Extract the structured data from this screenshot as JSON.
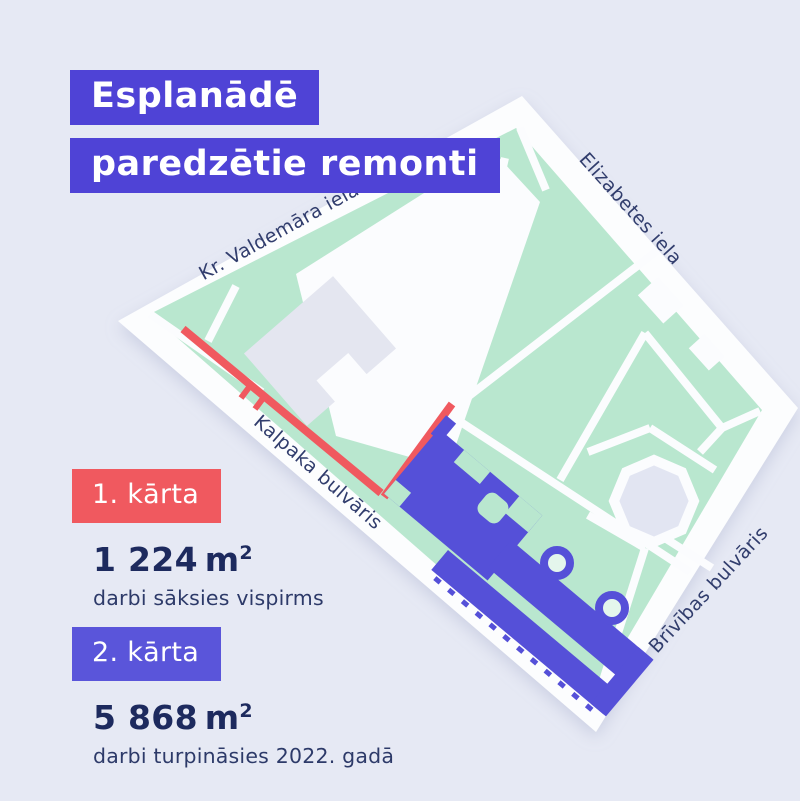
{
  "page": {
    "background_color": "#e6e9f4"
  },
  "title": {
    "line1": "Esplanādē",
    "line2": "paredzētie remonti",
    "bg_color": "#4f43d6",
    "text_color": "#ffffff"
  },
  "map": {
    "streets": [
      {
        "id": "kr-valdemara-iela",
        "label": "Kr. Valdemāra iela"
      },
      {
        "id": "elizabetes-iela",
        "label": "Elizabetes iela"
      },
      {
        "id": "kalpaka-bulvaris",
        "label": "Kalpaka bulvāris"
      },
      {
        "id": "brivibas-bulvaris",
        "label": "Brīvības bulvāris"
      }
    ],
    "park_color": "#b9e7cf",
    "map_base_color": "#fcfdfe",
    "building_color": "#e4e6f0",
    "phase1_route_color": "#f0595f",
    "phase2_area_color": "#5a55da",
    "label_color": "#313d6d"
  },
  "legend": {
    "phase1": {
      "badge": "1. kārta",
      "badge_color": "#f0595f",
      "area_value": "1 224",
      "area_unit": "m",
      "area_sup": "2",
      "description": "darbi sāksies vispirms"
    },
    "phase2": {
      "badge": "2. kārta",
      "badge_color": "#5a55da",
      "area_value": "5 868",
      "area_unit": "m",
      "area_sup": "2",
      "description": "darbi turpināsies 2022. gadā"
    }
  }
}
